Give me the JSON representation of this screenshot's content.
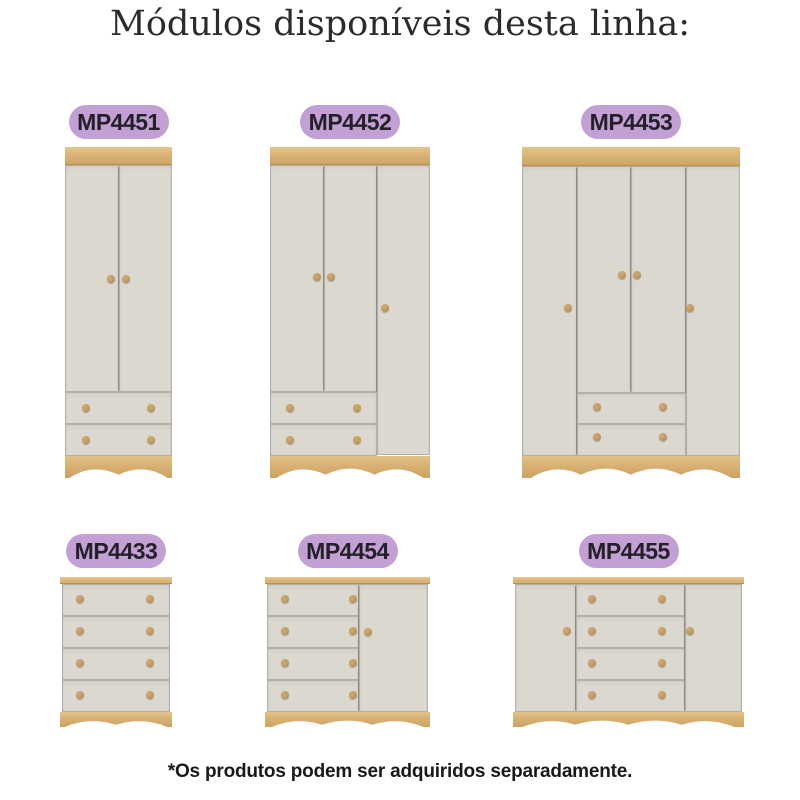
{
  "title": "Módulos disponíveis desta linha:",
  "footnote": "*Os produtos podem ser adquiridos separadamente.",
  "colors": {
    "pill": "#c2a0d5",
    "pill_text": "#232127",
    "wood": "#d8b173",
    "wood_highlight": "#e6c48c",
    "wood_dark": "#b68d53",
    "panel": "#dbd8d0",
    "knob": "#c19a62",
    "title_text": "#2b2b2b"
  },
  "modules": [
    {
      "code": "MP4451",
      "type": "wardrobe-2-doors-2-drawers"
    },
    {
      "code": "MP4452",
      "type": "wardrobe-3-doors-2-drawers"
    },
    {
      "code": "MP4453",
      "type": "wardrobe-4-doors-2-drawers"
    },
    {
      "code": "MP4433",
      "type": "chest-4-drawers"
    },
    {
      "code": "MP4454",
      "type": "dresser-4-drawers-1-door"
    },
    {
      "code": "MP4455",
      "type": "dresser-4-drawers-2-doors"
    }
  ]
}
